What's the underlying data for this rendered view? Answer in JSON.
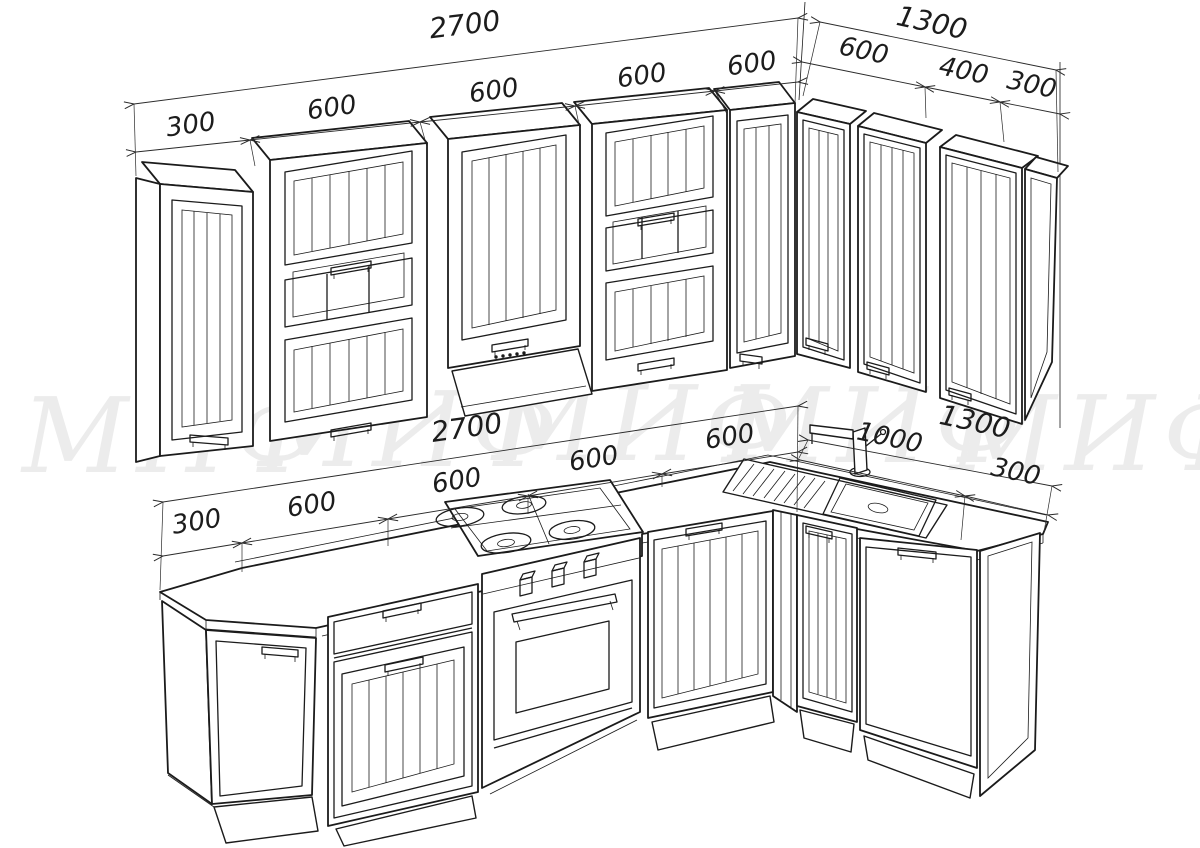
{
  "watermark": {
    "text": "МИФ",
    "color": "#ececec",
    "repeats": [
      "МИФ",
      "МИФ",
      "МИФ",
      "МИФ",
      "МИФ"
    ]
  },
  "dims": {
    "upper_front": {
      "overall": "2700",
      "segments": [
        "300",
        "600",
        "600",
        "600",
        "600"
      ]
    },
    "upper_right": {
      "overall": "1300",
      "segments": [
        "600",
        "400",
        "300"
      ]
    },
    "base_front": {
      "overall": "2700",
      "segments": [
        "300",
        "600",
        "600",
        "600",
        "600"
      ]
    },
    "base_right": {
      "overall": "1300",
      "segments": [
        "1000",
        "300"
      ]
    }
  }
}
